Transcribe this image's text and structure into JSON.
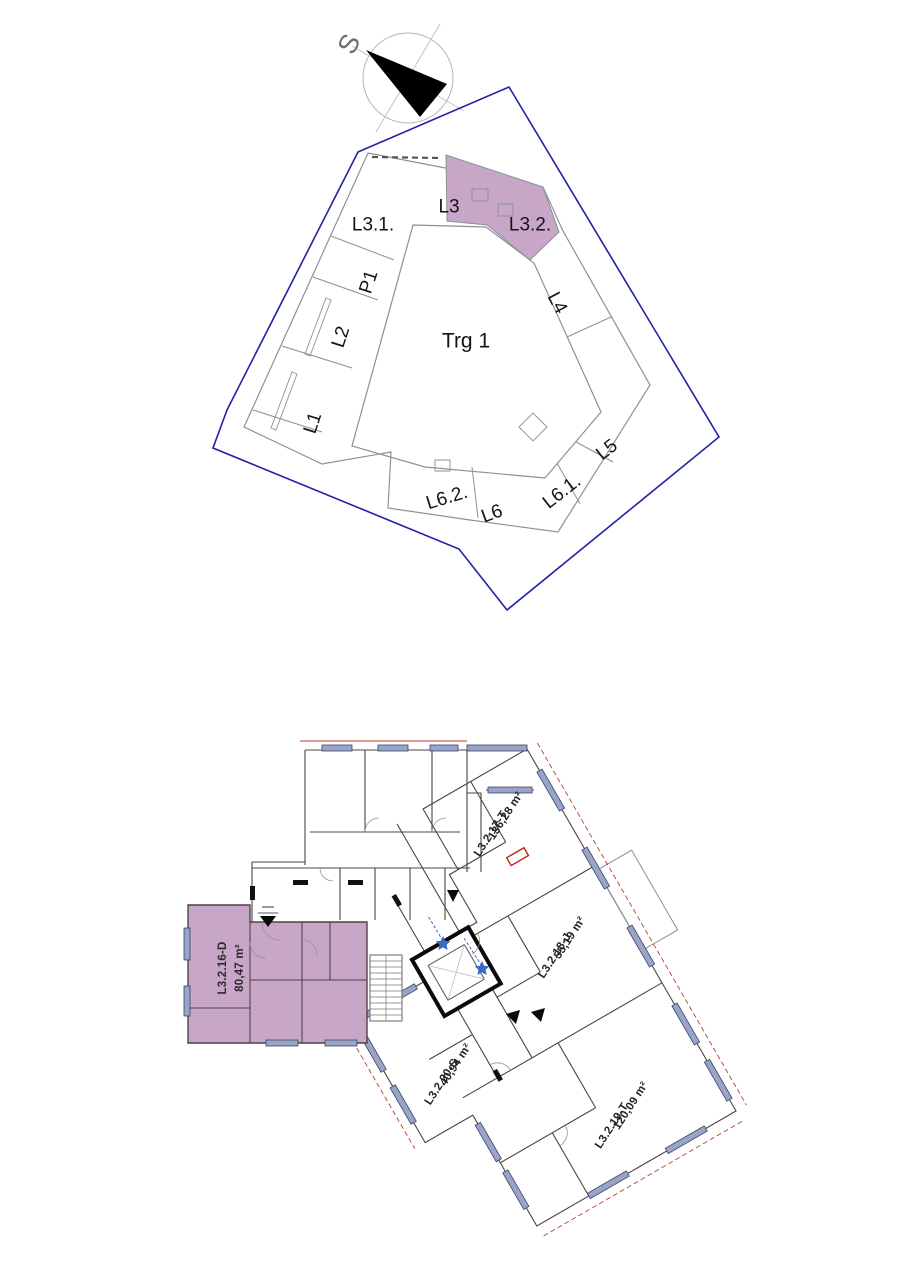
{
  "site_plan": {
    "north_label": "S",
    "plaza_label": "Trg 1",
    "blocks": [
      {
        "label": "L3.1."
      },
      {
        "label": "L3"
      },
      {
        "label": "L3.2."
      },
      {
        "label": "P1"
      },
      {
        "label": "L2"
      },
      {
        "label": "L1"
      },
      {
        "label": "L4"
      },
      {
        "label": "L5"
      },
      {
        "label": "L6.1."
      },
      {
        "label": "L6"
      },
      {
        "label": "L6.2."
      }
    ]
  },
  "floor_plan": {
    "units": [
      {
        "id": "L3.2.16-D",
        "area": "80,47 m²",
        "highlighted": true
      },
      {
        "id": "L3.2.17-T",
        "area": "136,28 m²",
        "highlighted": false
      },
      {
        "id": "L3.2.18-J",
        "area": "55,19 m²",
        "highlighted": false
      },
      {
        "id": "L3.2.19-T",
        "area": "120,09 m²",
        "highlighted": false
      },
      {
        "id": "L3.2.20-S",
        "area": "40,94 m²",
        "highlighted": false
      }
    ]
  },
  "colors": {
    "unit_highlight": "#c7a6c8",
    "parcel_boundary": "#2222a8",
    "window_symbol": "#9aa4c6",
    "dimension_red": "#c03a2b",
    "marker_blue": "#3a6bc4"
  }
}
